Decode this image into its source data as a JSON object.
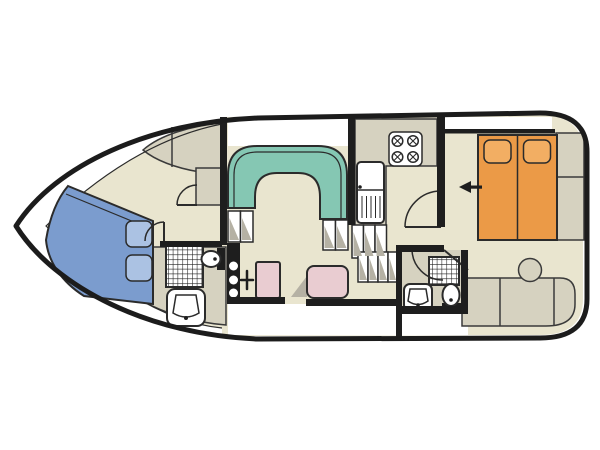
{
  "canvas": {
    "width": 600,
    "height": 450,
    "background": "#ffffff"
  },
  "palette": {
    "hull": "#1c1c1c",
    "wall": "#1e1e1e",
    "outline": "#2b2b2b",
    "floor": "#e9e5cf",
    "deck": "#d6d2c0",
    "white": "#ffffff",
    "vberth_blue": "#7b9cce",
    "pillow_blue": "#abc2e3",
    "dinette_teal": "#85c7b3",
    "bed_orange": "#eb9a47",
    "pillow_orange": "#f2ae63",
    "seat_pink": "#e9ccd1",
    "shade": "#b5b1a4"
  },
  "annotations": {
    "entry_arrow_direction": "left"
  }
}
